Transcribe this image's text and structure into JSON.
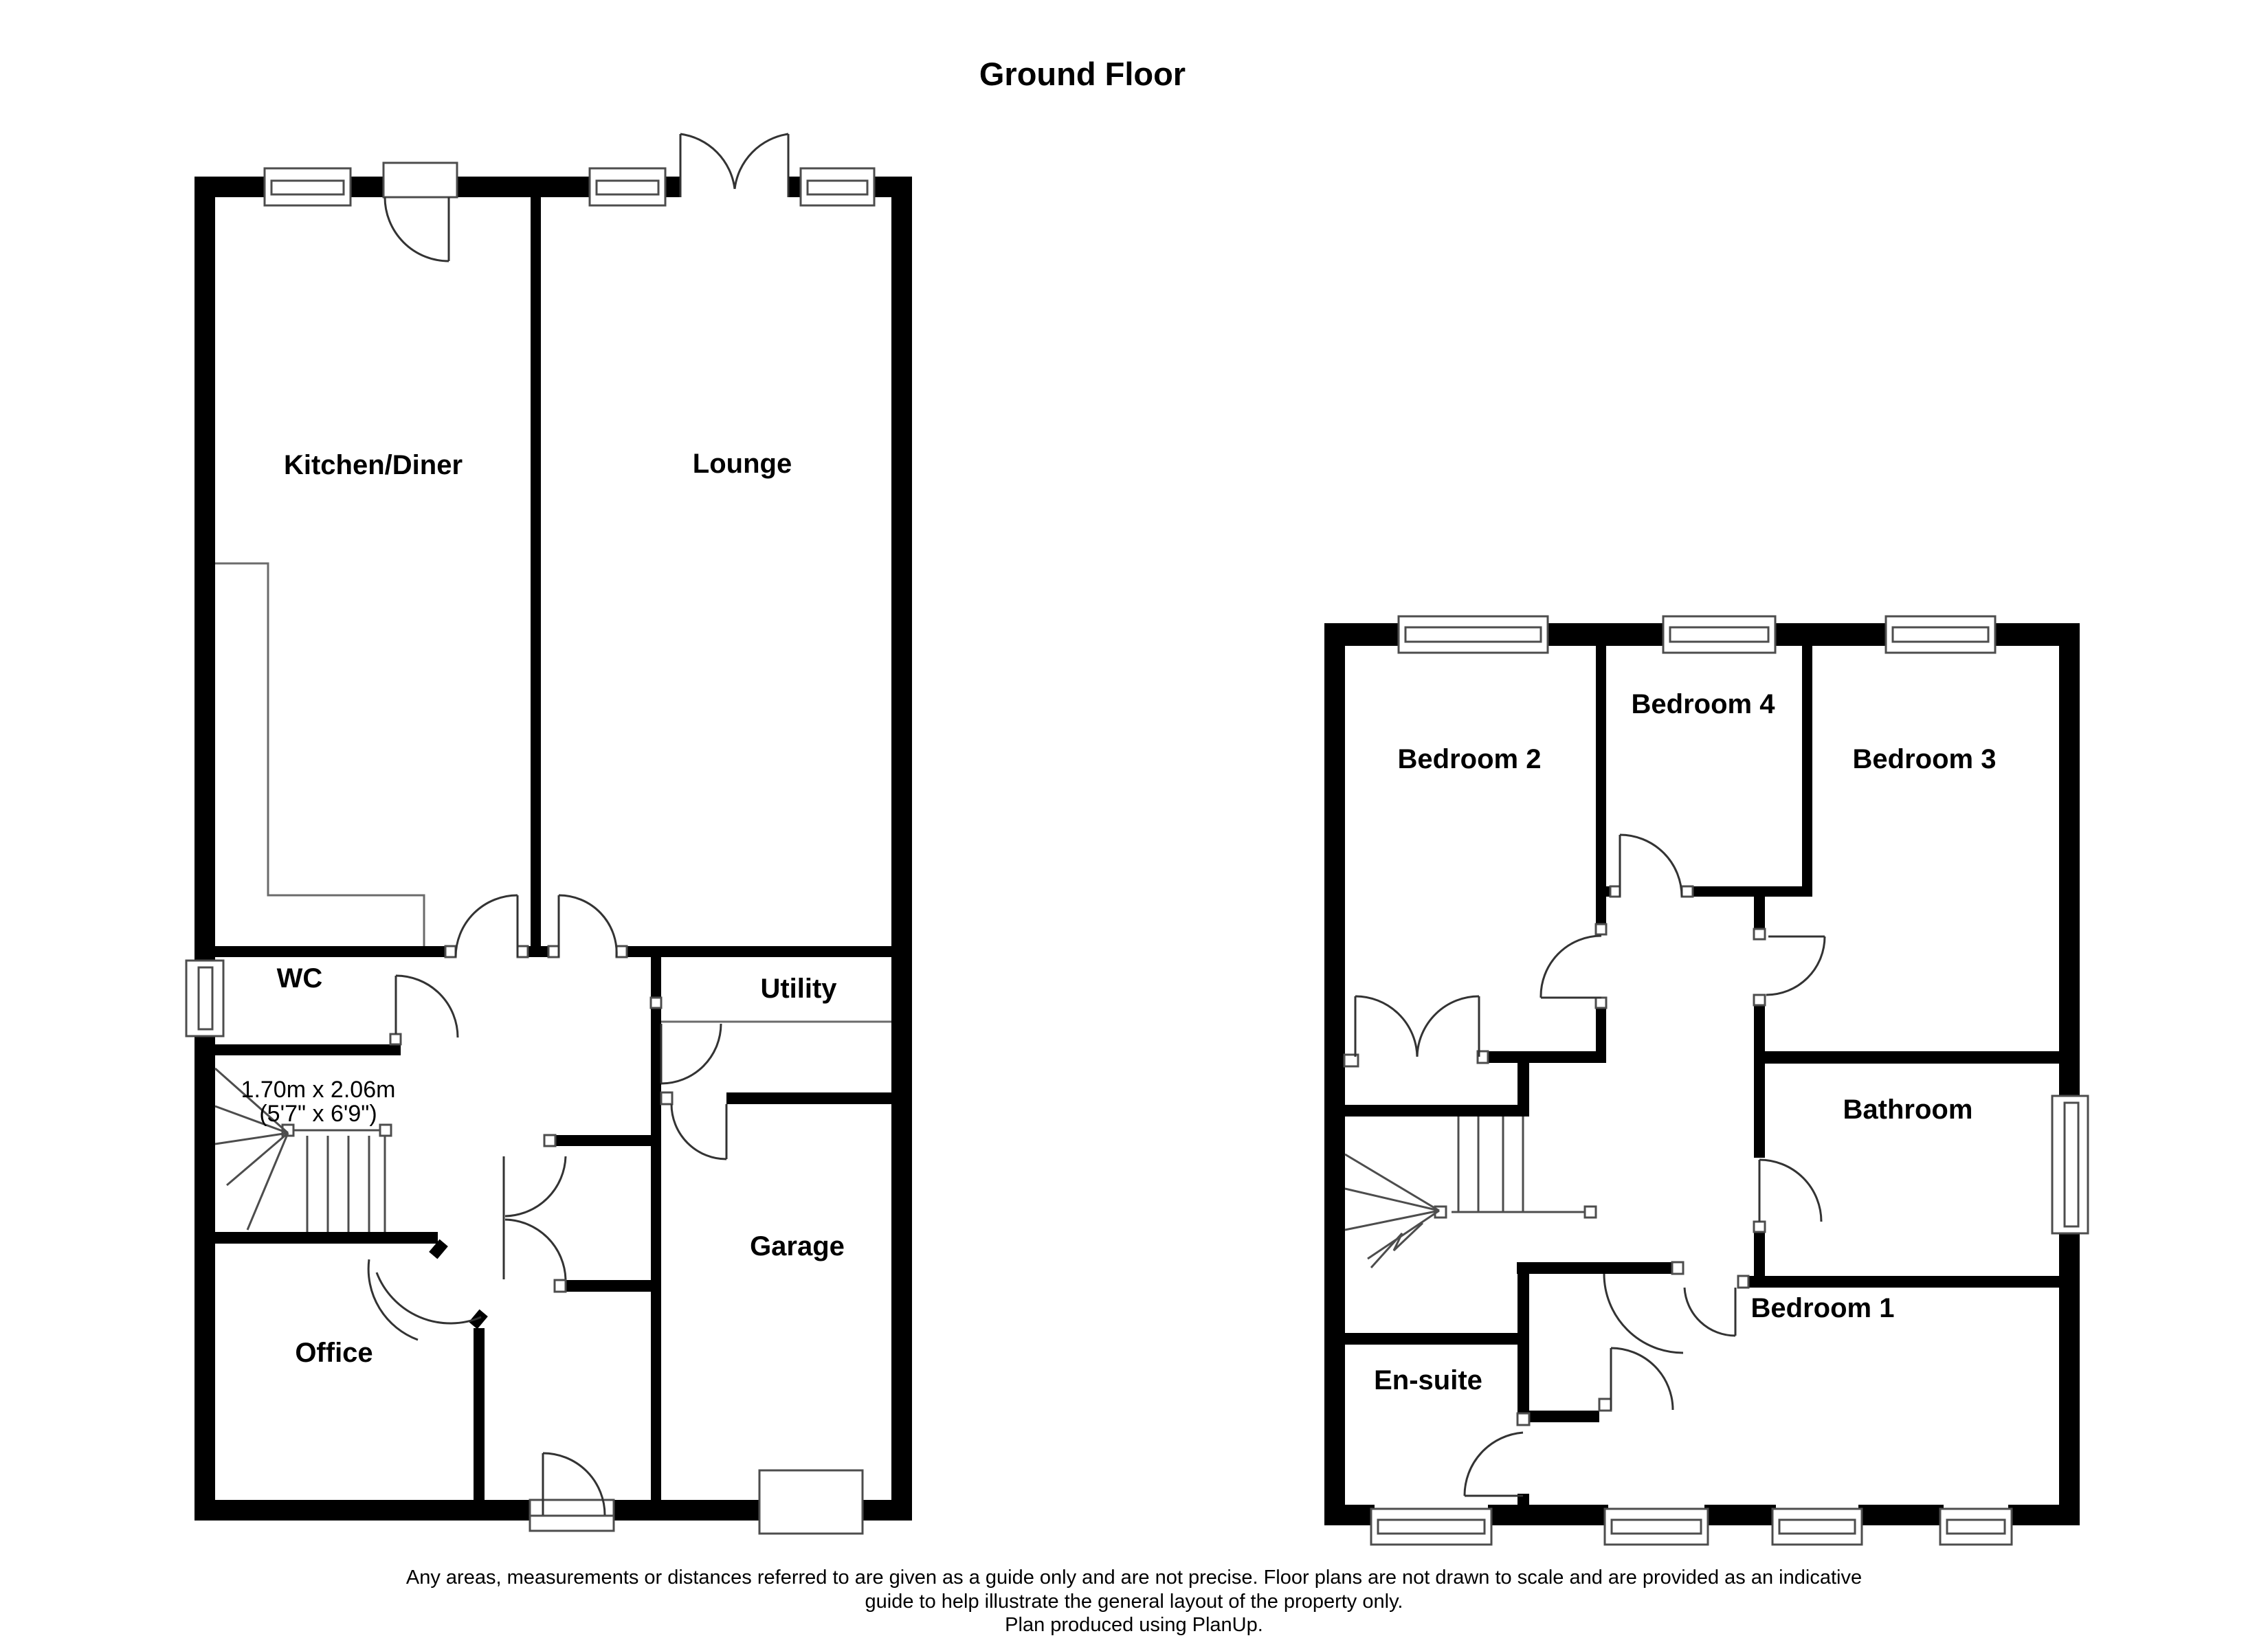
{
  "title": "Ground Floor",
  "ground_floor": {
    "rooms": {
      "kitchen_diner": "Kitchen/Diner",
      "lounge": "Lounge",
      "wc": "WC",
      "utility": "Utility",
      "garage": "Garage",
      "office": "Office"
    },
    "stairs_dimension": {
      "metric": "1.70m x 2.06m",
      "imperial": "(5'7\" x 6'9\")"
    }
  },
  "first_floor": {
    "rooms": {
      "bedroom2": "Bedroom 2",
      "bedroom4": "Bedroom 4",
      "bedroom3": "Bedroom 3",
      "bathroom": "Bathroom",
      "bedroom1": "Bedroom 1",
      "ensuite": "En-suite"
    }
  },
  "disclaimer": {
    "line1": "Any areas, measurements or distances referred to are given as a guide only and are not precise. Floor plans are not drawn to scale and are provided as an indicative",
    "line2": "guide to help illustrate the general layout of the property only.",
    "line3": "Plan produced using PlanUp."
  },
  "colors": {
    "wall": "#000000",
    "background": "#ffffff",
    "symbol_line": "#4d4d4d"
  }
}
